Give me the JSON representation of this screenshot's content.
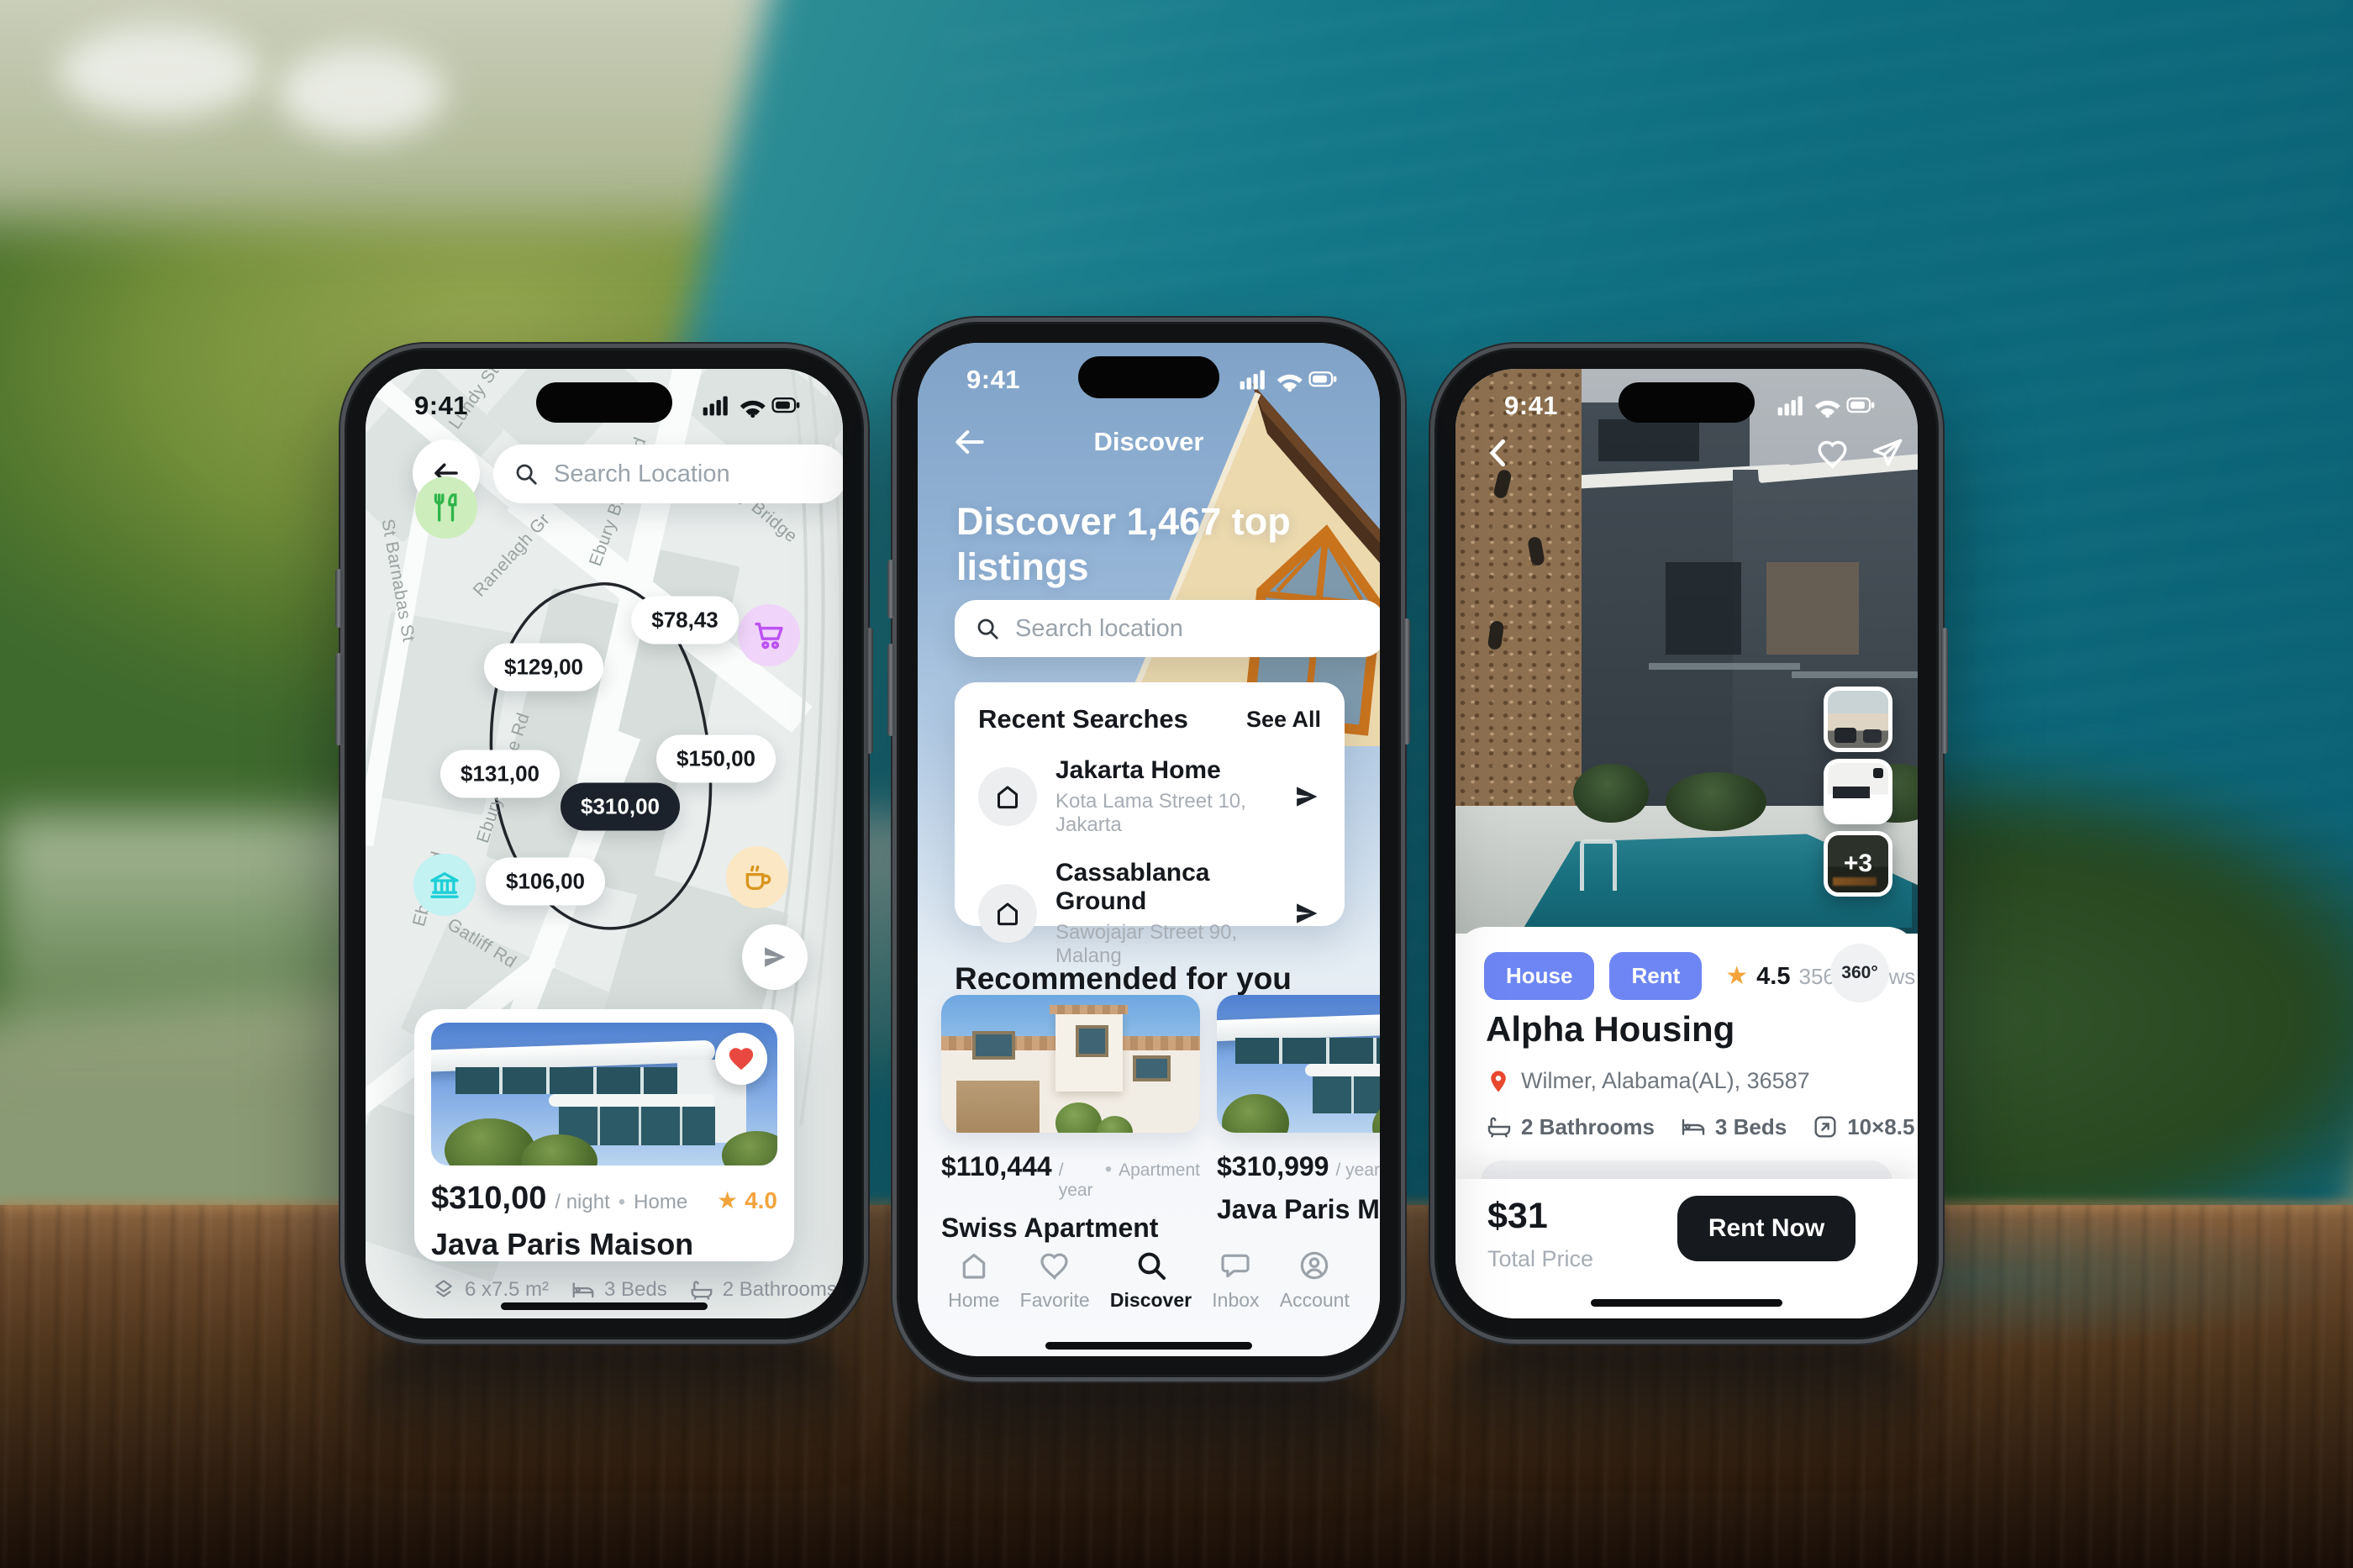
{
  "app": {
    "time": "9:41"
  },
  "icons": {
    "star": "★",
    "dot": "•",
    "badge_360": "360°",
    "gallery_more": "+3"
  },
  "map_screen": {
    "search_placeholder": "Search Location",
    "streets": {
      "lundy": "Lundy St",
      "ranelagh": "Ranelagh Gr",
      "ebury_bridge_rd": "Ebury Bridge Rd",
      "ebury_bridge": "Ebury Bridge",
      "st_barnabas": "St Barnabas St",
      "ebury_rd": "Ebury Rd",
      "gatliff": "Gatliff Rd"
    },
    "pins": [
      {
        "label": "$78,43"
      },
      {
        "label": "$129,00"
      },
      {
        "label": "$131,00"
      },
      {
        "label": "$150,00"
      },
      {
        "label": "$310,00"
      },
      {
        "label": "$106,00"
      }
    ],
    "listing": {
      "price": "$310,00",
      "unit": "/ night",
      "type": "Home",
      "rating": "4.0",
      "title": "Java Paris Maison",
      "area": "6 x7.5 m²",
      "beds": "3 Beds",
      "baths": "2 Bathrooms"
    }
  },
  "discover_screen": {
    "nav_title": "Discover",
    "heading": "Discover 1,467 top listings",
    "search_placeholder": "Search location",
    "recent": {
      "title": "Recent Searches",
      "action": "See All",
      "items": [
        {
          "title": "Jakarta Home",
          "subtitle": "Kota Lama Street 10, Jakarta"
        },
        {
          "title": "Cassablanca Ground",
          "subtitle": "Sawojajar Street 90, Malang"
        }
      ]
    },
    "recommended": {
      "title": "Recommended for you",
      "cards": [
        {
          "price": "$110,444",
          "unit": "/ year",
          "type": "Apartment",
          "title": "Swiss Apartment"
        },
        {
          "price": "$310,999",
          "unit": "/ year",
          "title": "Java Paris Maison"
        }
      ]
    },
    "tabs": [
      {
        "label": "Home"
      },
      {
        "label": "Favorite"
      },
      {
        "label": "Discover"
      },
      {
        "label": "Inbox"
      },
      {
        "label": "Account"
      }
    ]
  },
  "detail_screen": {
    "tags": [
      {
        "label": "House"
      },
      {
        "label": "Rent"
      }
    ],
    "rating": "4.5",
    "reviews": "356 reviews",
    "title": "Alpha Housing",
    "location": "Wilmer, Alabama(AL), 36587",
    "features": [
      {
        "label": "2 Bathrooms"
      },
      {
        "label": "3 Beds"
      },
      {
        "label": "10×8.5 m²"
      }
    ],
    "agent": {
      "name": "Cody Fisher"
    },
    "footer": {
      "price": "$31",
      "caption": "Total Price",
      "cta": "Rent Now"
    }
  },
  "colors": {
    "accent_blue": "#6d86f3",
    "star_orange": "#f2a33c",
    "heart_red": "#e8483f",
    "dark": "#16191d",
    "muted": "#9aa1a8"
  }
}
